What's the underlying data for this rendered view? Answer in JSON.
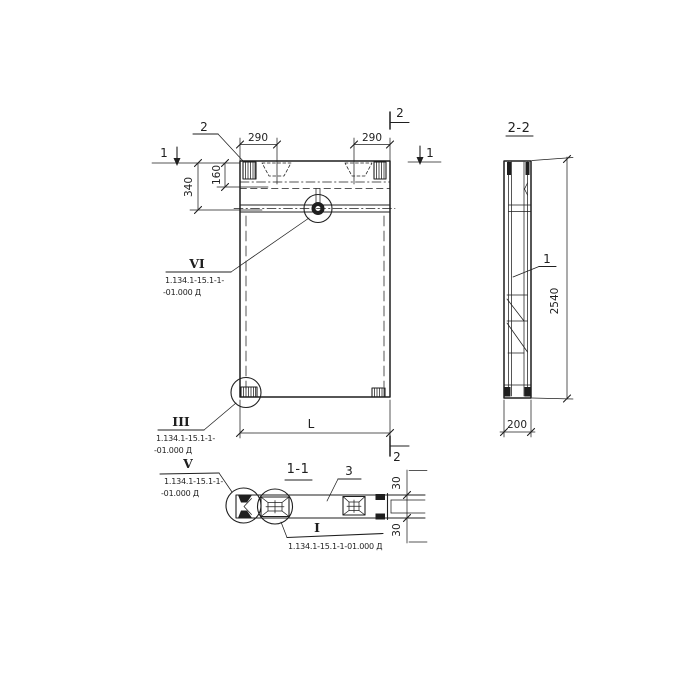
{
  "colors": {
    "ink": "#1f1f1f",
    "paper": "#ffffff"
  },
  "front_view": {
    "marker_section_2_top": "2",
    "marker_section_2_bottom": "2",
    "marker_view_1_left": "1",
    "marker_view_1_right": "1",
    "leader_detail_2": "2",
    "dim_290_left": "290",
    "dim_290_right": "290",
    "dim_160": "160",
    "dim_340": "340",
    "dim_length": "L",
    "callout_vi": {
      "label": "VI",
      "doc1": "1.134.1-15.1-1-",
      "doc2": "-01.000 Д"
    },
    "callout_iii": {
      "label": "III",
      "doc1": "1.134.1-15.1-1-",
      "doc2": "-01.000 Д"
    }
  },
  "section_2_2": {
    "title": "2-2",
    "leader_detail_1": "1",
    "dim_2540": "2540",
    "dim_200": "200"
  },
  "section_1_1": {
    "title": "1-1",
    "leader_detail_3": "3",
    "dim_30_top": "30",
    "dim_30_bottom": "30",
    "callout_v": {
      "label": "V",
      "doc1": "1.134.1-15.1-1-",
      "doc2": "-01.000 Д"
    },
    "callout_i": {
      "label": "I",
      "doc": "1.134.1-15.1-1-01.000 Д"
    }
  }
}
